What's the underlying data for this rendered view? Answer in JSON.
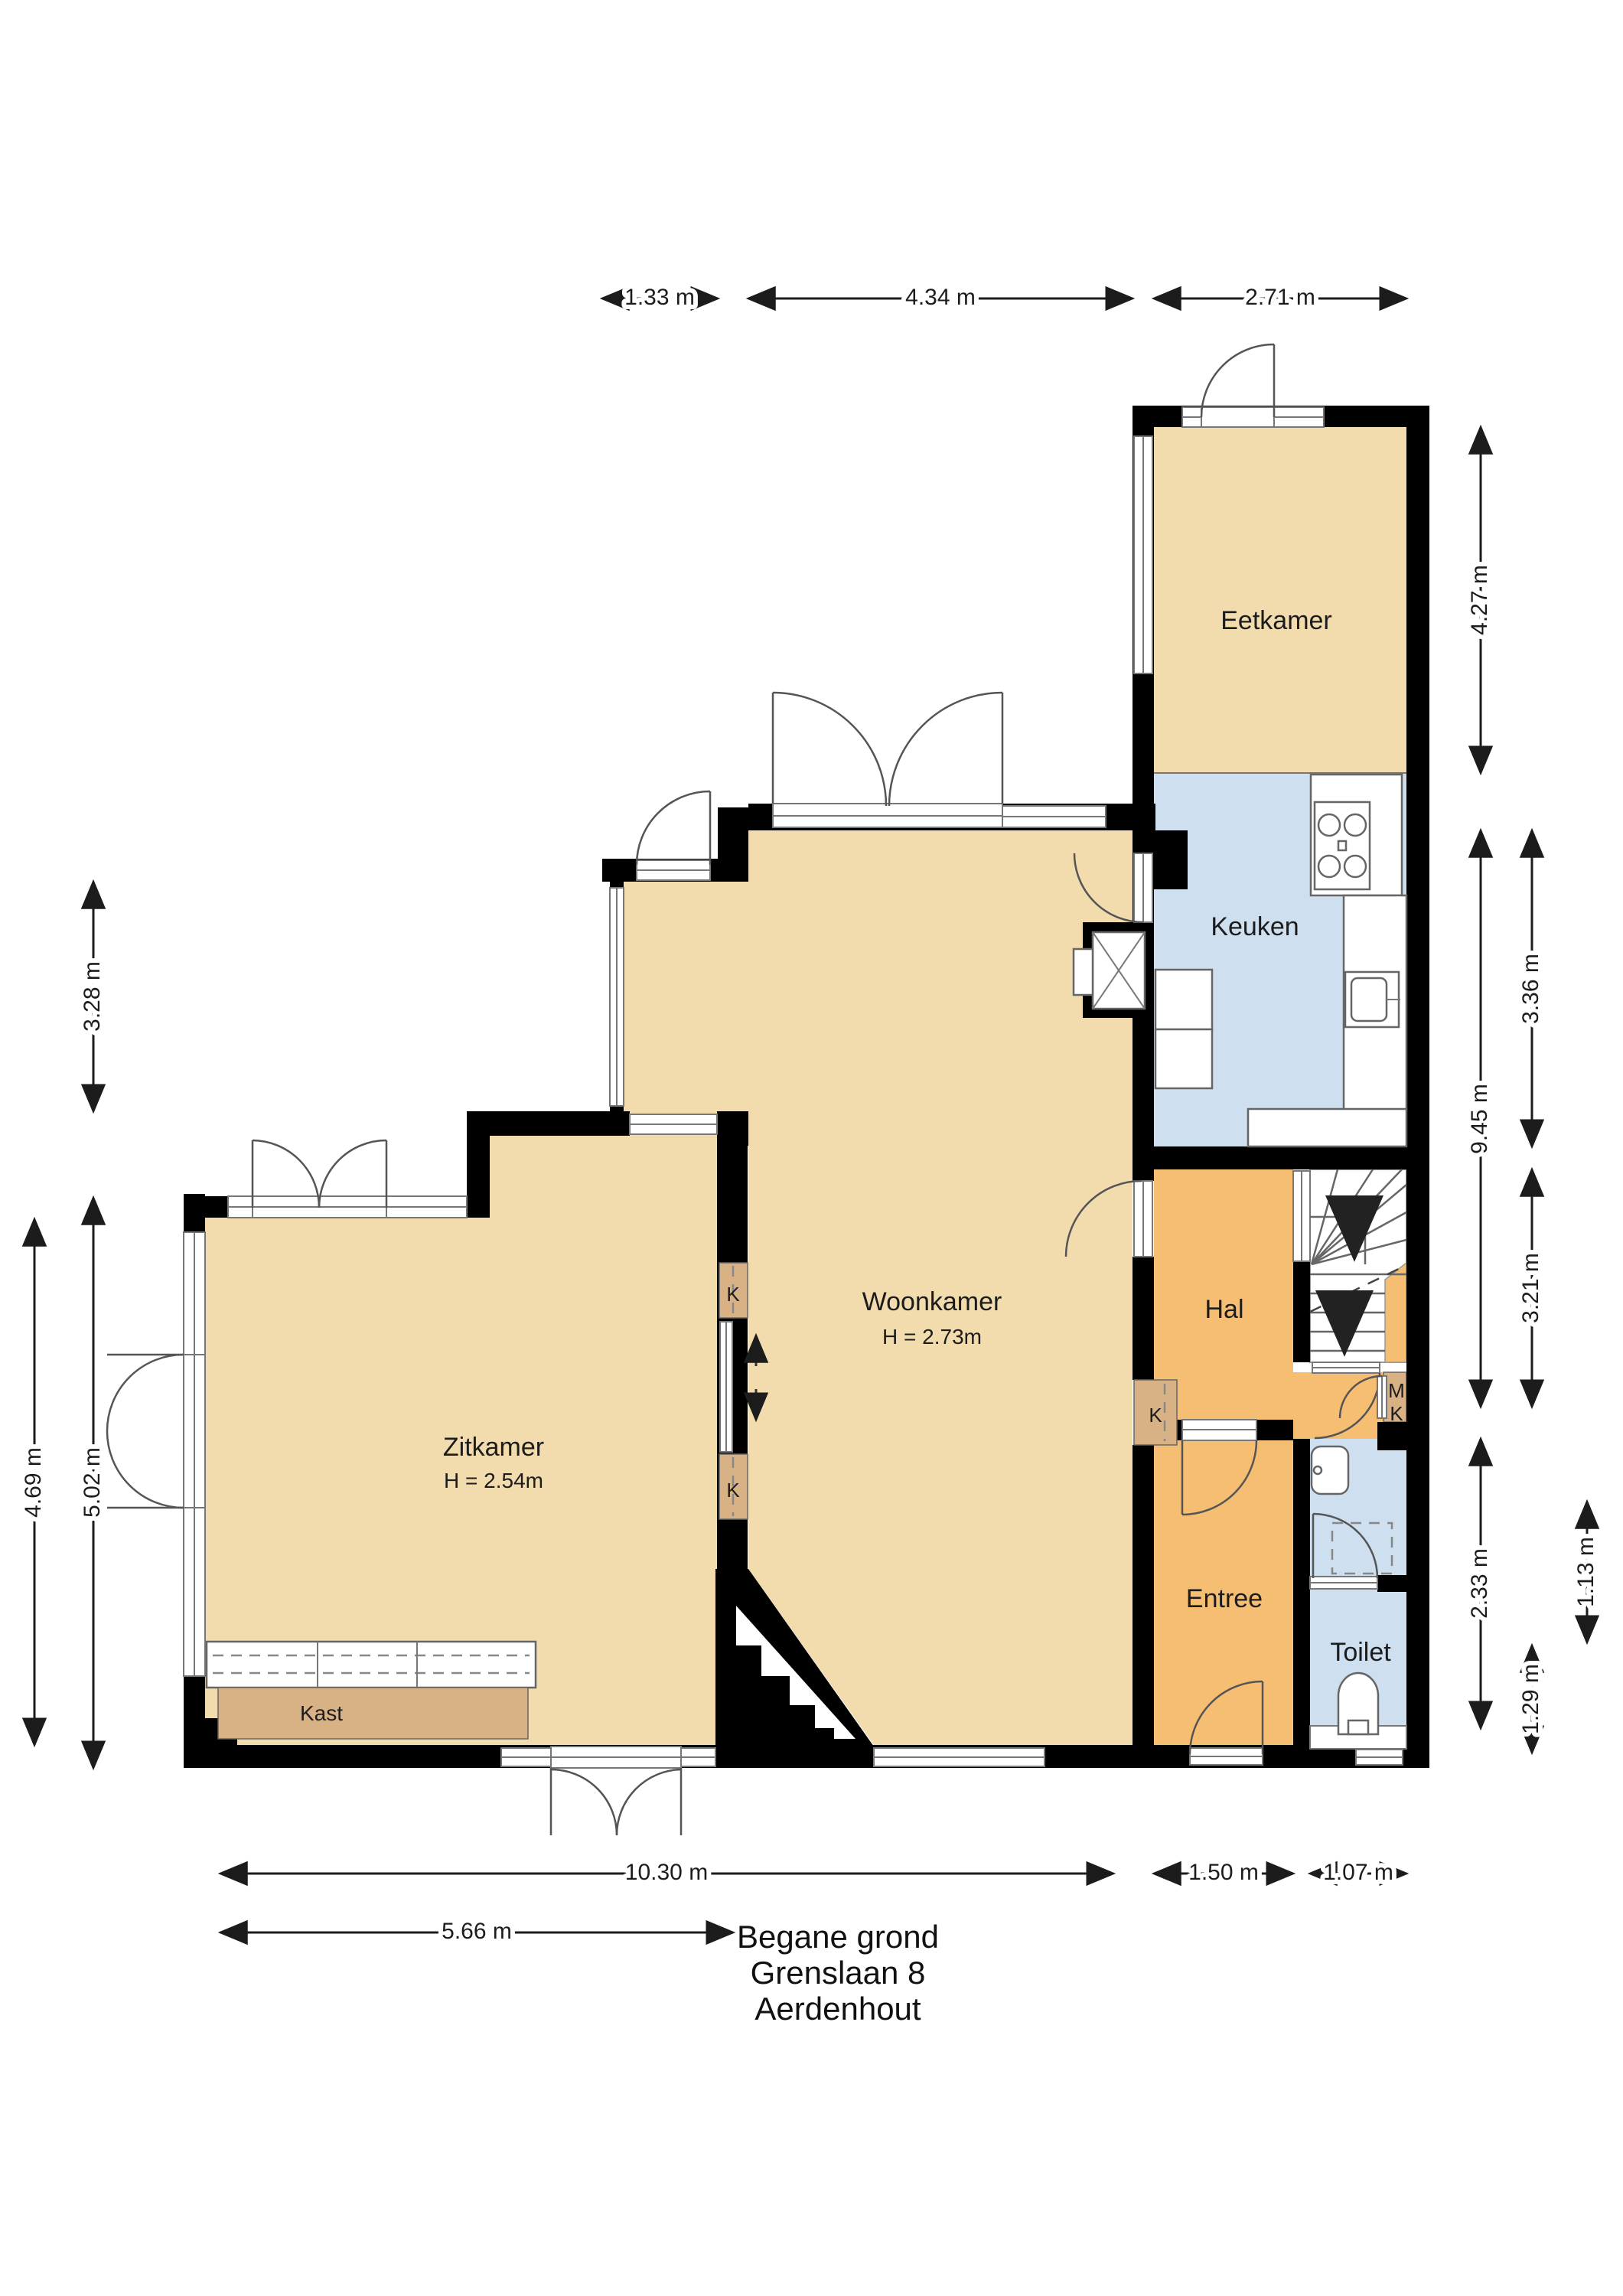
{
  "colors": {
    "floor_beige": "#F2DBAC",
    "floor_orange": "#F6BE72",
    "floor_blue": "#CEDFEF",
    "closet_tan": "#D8B284",
    "wall_black": "#000000"
  },
  "title": {
    "line1": "Begane grond",
    "line2": "Grenslaan 8",
    "line3": "Aerdenhout"
  },
  "rooms": {
    "eetkamer": {
      "label": "Eetkamer"
    },
    "keuken": {
      "label": "Keuken"
    },
    "woonkamer": {
      "label": "Woonkamer",
      "ceiling": "H = 2.73m"
    },
    "zitkamer": {
      "label": "Zitkamer",
      "ceiling": "H = 2.54m"
    },
    "hal": {
      "label": "Hal"
    },
    "entree": {
      "label": "Entree"
    },
    "toilet": {
      "label": "Toilet"
    },
    "kast": {
      "label": "Kast"
    }
  },
  "closets": {
    "k1": "K",
    "k2": "K",
    "k3": "K",
    "mk_m": "M",
    "mk_k": "K"
  },
  "dims": {
    "d133": "1.33 m",
    "d434": "4.34 m",
    "d271": "2.71 m",
    "d328": "3.28 m",
    "d469": "4.69 m",
    "d502": "5.02 m",
    "d427": "4.27 m",
    "d945": "9.45 m",
    "d336": "3.36 m",
    "d321": "3.21 m",
    "d233": "2.33 m",
    "d129": "1.29 m",
    "d113": "1.13 m",
    "d1030": "10.30 m",
    "d150": "1.50 m",
    "d107": "1.07 m",
    "d566": "5.66 m"
  }
}
